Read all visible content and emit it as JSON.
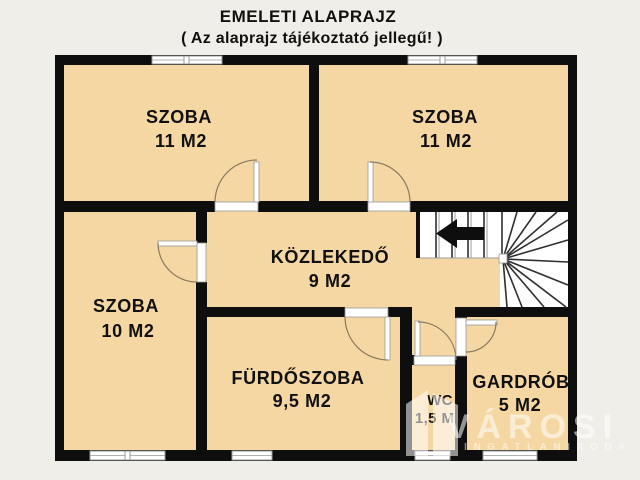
{
  "title": {
    "line1": "EMELETI ALAPRAJZ",
    "line2": "( Az alaprajz tájékoztató jellegű! )"
  },
  "rooms": {
    "szoba_top_left": {
      "name": "SZOBA",
      "area": "11 M2"
    },
    "szoba_top_right": {
      "name": "SZOBA",
      "area": "11 M2"
    },
    "szoba_bottom_left": {
      "name": "SZOBA",
      "area": "10 M2"
    },
    "kozlekedo": {
      "name": "KÖZLEKEDŐ",
      "area": "9 M2"
    },
    "furdoszoba": {
      "name": "FÜRDŐSZOBA",
      "area": "9,5 M2"
    },
    "wc": {
      "name": "WC",
      "area": "1,5 M2"
    },
    "gardrob": {
      "name": "GARDRÓB",
      "area": "5 M2"
    }
  },
  "stairs": {
    "direction_icon": "left-arrow-icon"
  },
  "watermark": {
    "brand": "VÁROSI",
    "tagline": "INGATLANIRODA"
  },
  "colors": {
    "background": "#f0eee8",
    "floor": "#f5d7a4",
    "wall": "#0e0e0e",
    "door": "#8b7a5e",
    "frame": "#9a9a9a",
    "stair_line": "#2f2f2f",
    "text": "#111111",
    "watermark": "#ffffff"
  }
}
